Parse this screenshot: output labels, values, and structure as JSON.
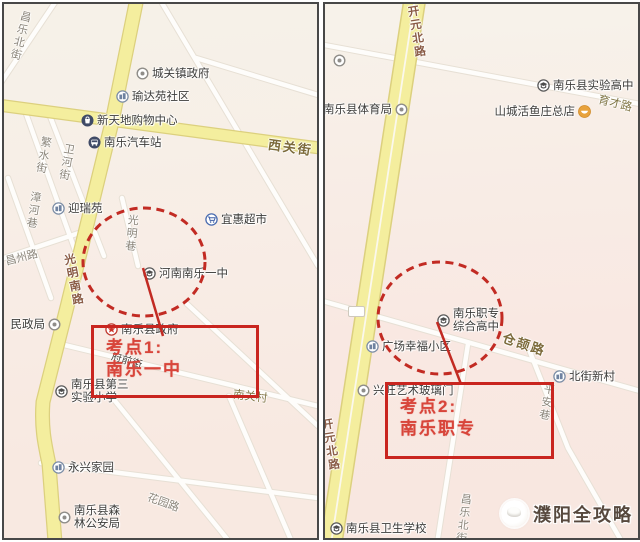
{
  "watermark": {
    "text": "濮阳全攻略"
  },
  "left_map": {
    "exam_box": {
      "line1": "考点1:",
      "line2": "南乐一中"
    },
    "pois": [
      {
        "id": "chengguan-town-gov",
        "label": "城关镇政府",
        "icon": "dot-icon",
        "x": 132,
        "y": 62
      },
      {
        "id": "yudayuan-community",
        "label": "瑜达苑社区",
        "icon": "building-icon",
        "x": 112,
        "y": 85
      },
      {
        "id": "xintiandi-mall",
        "label": "新天地购物中心",
        "icon": "mall-icon",
        "x": 77,
        "y": 109
      },
      {
        "id": "nanle-bus-station",
        "label": "南乐汽车站",
        "icon": "bus-icon",
        "x": 84,
        "y": 131
      },
      {
        "id": "yingruiyuan",
        "label": "迎瑞苑",
        "icon": "building-icon",
        "x": 48,
        "y": 197
      },
      {
        "id": "yihui-supermarket",
        "label": "宜惠超市",
        "icon": "cart-icon",
        "x": 201,
        "y": 208
      },
      {
        "id": "henan-nanle-no1",
        "label": "河南南乐一中",
        "icon": "school-icon",
        "x": 139,
        "y": 262
      },
      {
        "id": "civil-affairs-bureau",
        "label": "民政局",
        "icon": "dot-icon",
        "x": 44,
        "y": 313,
        "side": "left"
      },
      {
        "id": "nanle-county-gov",
        "label": "南乐县政府",
        "icon": "gov-icon",
        "x": 101,
        "y": 318
      },
      {
        "id": "third-experimental-primary",
        "lines": [
          "南乐县第三",
          "实验小学"
        ],
        "icon": "school-icon",
        "x": 51,
        "y": 384
      },
      {
        "id": "yongxing-homes",
        "label": "永兴家园",
        "icon": "building-icon",
        "x": 48,
        "y": 456
      },
      {
        "id": "forest-police",
        "lines": [
          "南乐县森",
          "林公安局"
        ],
        "icon": "dot-icon",
        "x": 54,
        "y": 510
      }
    ],
    "road_labels": [
      {
        "id": "changle-north-st",
        "text": "昌乐北街",
        "x": 8,
        "y": 6,
        "vertical": true,
        "rot": 14,
        "cls": "rd"
      },
      {
        "id": "fanshui-st",
        "text": "繁水街",
        "x": 31,
        "y": 132,
        "vertical": true,
        "rot": 10,
        "cls": "rd"
      },
      {
        "id": "weihe-st",
        "text": "卫河街",
        "x": 54,
        "y": 139,
        "vertical": true,
        "rot": 10,
        "cls": "rd"
      },
      {
        "id": "zhanghe-lane",
        "text": "漳河巷",
        "x": 21,
        "y": 187,
        "vertical": true,
        "rot": 8,
        "cls": "rd"
      },
      {
        "id": "changzhou-rd",
        "text": "昌州路",
        "x": 1,
        "y": 245,
        "rot": -14,
        "cls": "rd"
      },
      {
        "id": "xiguan-st",
        "text": "西关街",
        "x": 264,
        "y": 133,
        "rot": 8,
        "cls": "rd-main"
      },
      {
        "id": "guangming-south-rd",
        "text": "光明南路",
        "x": 61,
        "y": 249,
        "vertical": true,
        "rot": -11,
        "cls": "rd-yellow"
      },
      {
        "id": "guangming-lane",
        "text": "光明巷",
        "x": 119,
        "y": 210,
        "vertical": true,
        "rot": 6,
        "cls": "rd"
      },
      {
        "id": "fuqian-st",
        "text": "府前街",
        "x": 107,
        "y": 349,
        "rot": 17,
        "cls": "rd-dark"
      },
      {
        "id": "nanguan-village",
        "text": "南关村",
        "x": 229,
        "y": 384,
        "rot": 7,
        "cls": "rd-village"
      },
      {
        "id": "huayuan-rd",
        "text": "花园路",
        "x": 143,
        "y": 490,
        "rot": 20,
        "cls": "rd"
      }
    ]
  },
  "right_map": {
    "exam_box": {
      "line1": "考点2:",
      "line2": "南乐职专"
    },
    "pois": [
      {
        "id": "unnamed-poi",
        "label": "",
        "icon": "dot-icon",
        "x": 8,
        "y": 51
      },
      {
        "id": "nanle-sports-bureau",
        "label": "南乐县体育局",
        "icon": "dot-icon",
        "x": 70,
        "y": 98,
        "side": "left"
      },
      {
        "id": "nanle-experimental-high",
        "label": "南乐县实验高中",
        "icon": "school-icon",
        "x": 212,
        "y": 74
      },
      {
        "id": "shancheng-fish-restaurant",
        "label": "山城活鱼庄总店",
        "icon": "food-icon",
        "x": 253,
        "y": 100,
        "side": "left"
      },
      {
        "id": "nanle-vocational-high",
        "lines": [
          "南乐职专",
          "综合高中"
        ],
        "icon": "school-icon",
        "x": 112,
        "y": 313
      },
      {
        "id": "guangchang-xingfu-community",
        "label": "广场幸福小区",
        "icon": "building-icon",
        "x": 41,
        "y": 335
      },
      {
        "id": "beijie-new-village",
        "label": "北街新村",
        "icon": "building-icon",
        "x": 228,
        "y": 365
      },
      {
        "id": "xingwang-art-glass-door",
        "label": "兴旺艺术玻璃门",
        "icon": "dot-icon",
        "x": 32,
        "y": 379
      },
      {
        "id": "nanle-health-school",
        "label": "南乐县卫生学校",
        "icon": "school-icon",
        "x": 5,
        "y": 517
      }
    ],
    "road_labels": [
      {
        "id": "kaiyuan-north-rd-top",
        "text": "开元北路",
        "x": 83,
        "y": 1,
        "vertical": true,
        "rot": -9,
        "cls": "rd-yellow"
      },
      {
        "id": "yucai-rd",
        "text": "育才路",
        "x": 273,
        "y": 91,
        "rot": 14,
        "cls": "rd-village"
      },
      {
        "id": "cangjie-rd",
        "text": "仓颉路",
        "x": 177,
        "y": 330,
        "rot": 18,
        "cls": "rd-main"
      },
      {
        "id": "pingan-lane",
        "text": "平安巷",
        "x": 213,
        "y": 379,
        "vertical": true,
        "rot": 10,
        "cls": "rd"
      },
      {
        "id": "changle-north-st-right",
        "text": "昌乐北街",
        "x": 130,
        "y": 489,
        "vertical": true,
        "rot": 7,
        "cls": "rd"
      },
      {
        "id": "kaiyuan-north-rd-bottom",
        "text": "开元北路",
        "x": -3,
        "y": 414,
        "vertical": true,
        "rot": -9,
        "cls": "rd-yellow"
      }
    ]
  }
}
